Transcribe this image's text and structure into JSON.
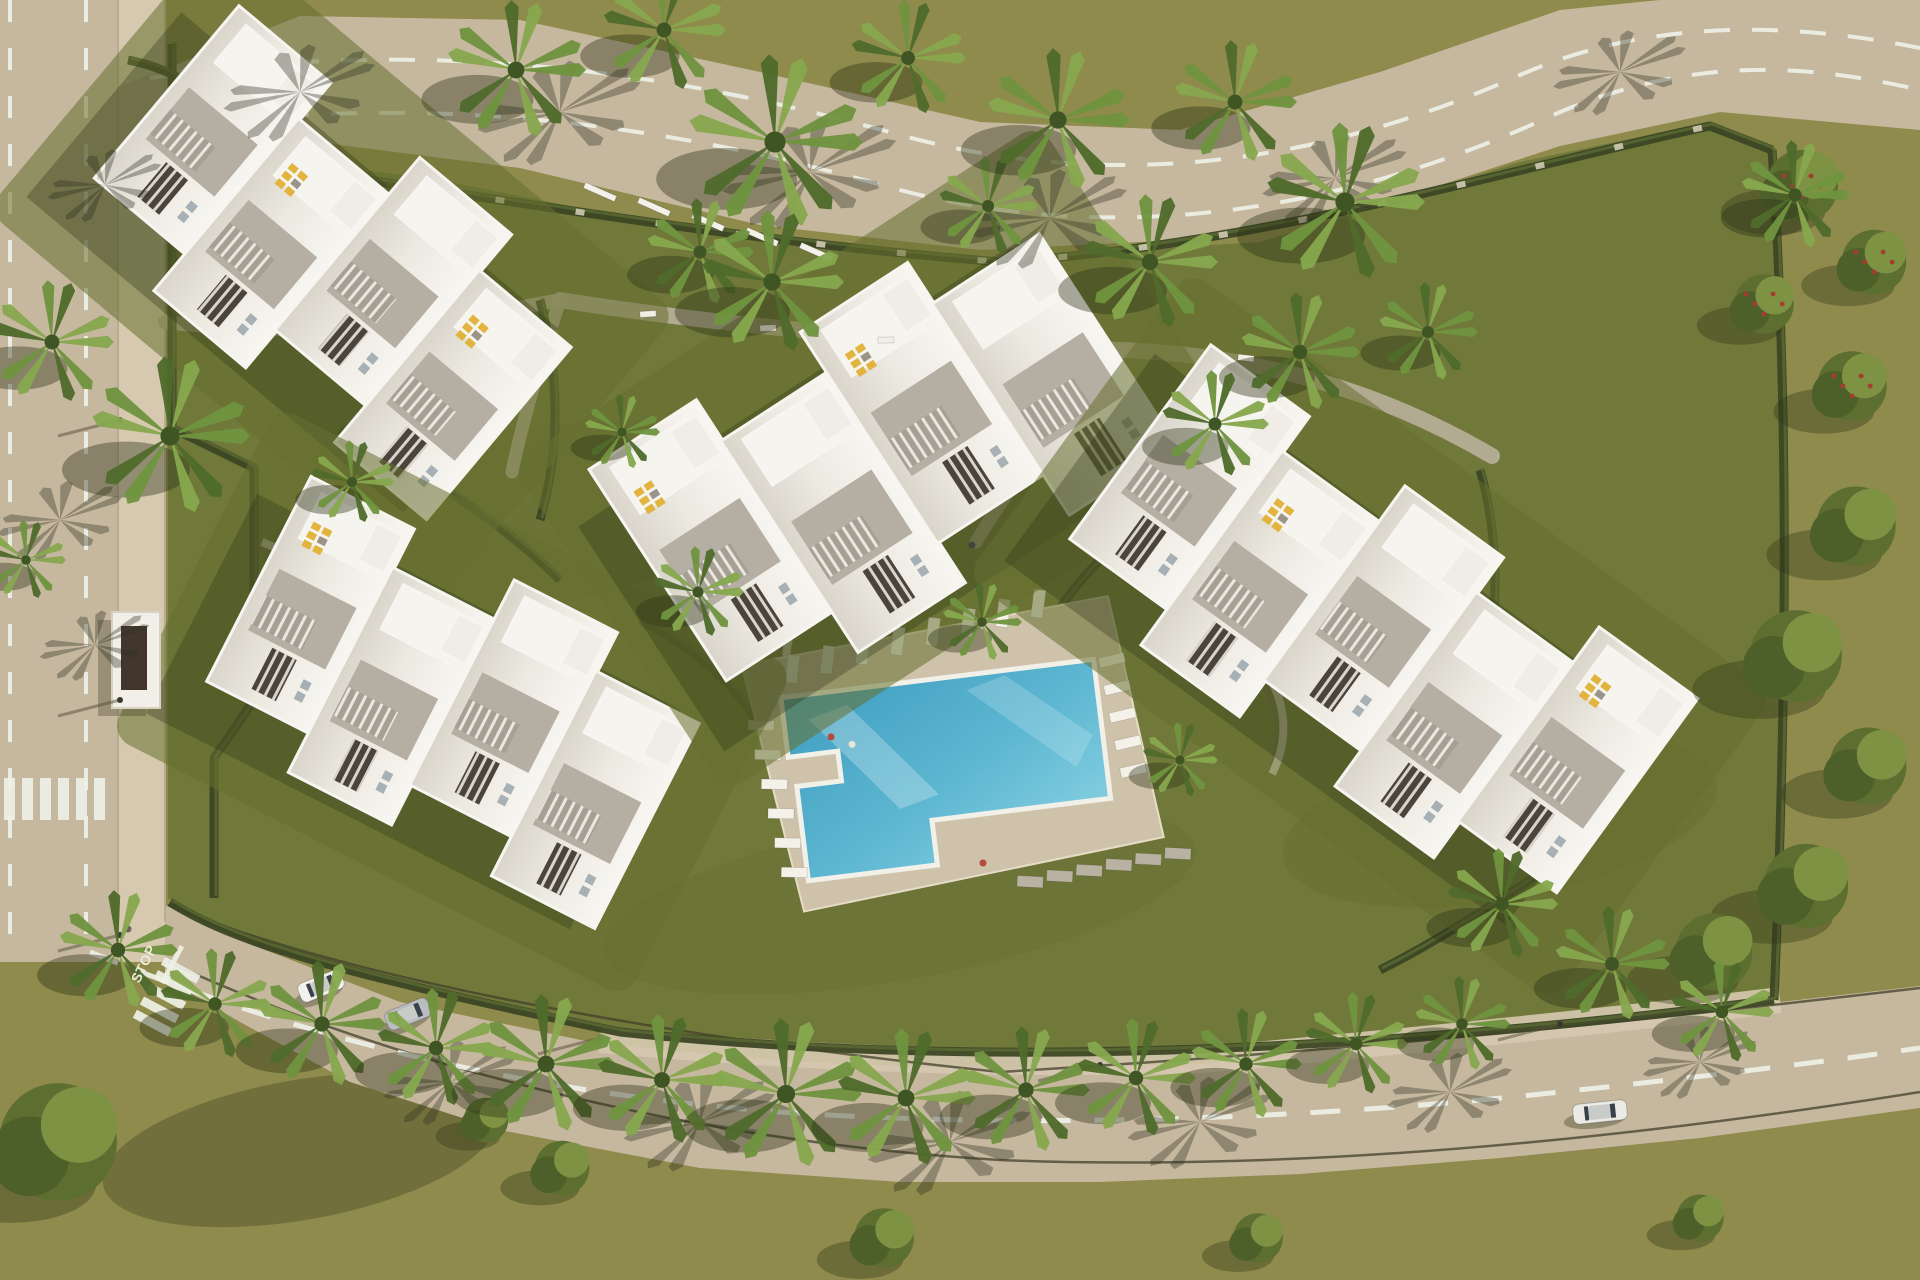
{
  "meta": {
    "description": "Aerial 3D render of a white apartment complex with cross-shaped pool, gardens, palm trees and curving roads",
    "width": 1920,
    "height": 1280
  },
  "palette": {
    "grass_outer": "#8e8b4c",
    "grass_site": "#71793a",
    "plot_tint": "#667030",
    "road": "#c6b89f",
    "sidewalk": "#d6c9b0",
    "road_line": "#eef0e6",
    "hedge": "#3c4624",
    "wall_light": "#d9d1be",
    "path": "#b6ad97",
    "roof_white": "#e9e6df",
    "roof_bright": "#f6f4ee",
    "roof_gray": "#b5aea3",
    "slot_dark": "#4a443b",
    "rail_bg": "#97918680",
    "parapet": "#f7f5f0",
    "lounger_yellow": "#e2b43e",
    "lounger_white": "#f3f1e8",
    "lounger_gray": "#b9b2a2",
    "pool_deck": "#cfc2aa",
    "pool_coping": "#f2f1e9",
    "water_dark": "#3e9dbf",
    "water_light": "#8fd5e5",
    "shadow": "#2e3317",
    "palm_light": "#86a84e",
    "palm_mid": "#6f9440",
    "palm_dark": "#4f6b2c",
    "tree_base": "#5c6e30",
    "tree_hi": "#7d9243",
    "flower_red": "#a33d2e"
  },
  "ground": {
    "site_poly": [
      [
        168,
        148
      ],
      [
        430,
        178
      ],
      [
        700,
        232
      ],
      [
        1000,
        258
      ],
      [
        1260,
        242
      ],
      [
        1520,
        162
      ],
      [
        1710,
        122
      ],
      [
        1775,
        148
      ],
      [
        1788,
        420
      ],
      [
        1782,
        720
      ],
      [
        1772,
        1000
      ],
      [
        1400,
        1044
      ],
      [
        1000,
        1068
      ],
      [
        620,
        1028
      ],
      [
        330,
        968
      ],
      [
        200,
        928
      ],
      [
        168,
        898
      ]
    ],
    "shade_blobs": [
      [
        520,
        520,
        260,
        90,
        0.08
      ],
      [
        1500,
        820,
        220,
        80,
        0.08
      ],
      [
        900,
        900,
        300,
        80,
        0.07
      ],
      [
        300,
        1150,
        200,
        70,
        0.3
      ]
    ]
  },
  "roads": {
    "left": {
      "x": 0,
      "w": 118,
      "sidewalk_w": 47,
      "y0": 0,
      "y1": 962
    },
    "left_dash_x": [
      10,
      86
    ],
    "top_poly": [
      [
        60,
        110
      ],
      [
        300,
        16
      ],
      [
        520,
        20
      ],
      [
        760,
        72
      ],
      [
        980,
        122
      ],
      [
        1180,
        130
      ],
      [
        1380,
        72
      ],
      [
        1560,
        10
      ],
      [
        1660,
        0
      ],
      [
        1920,
        0
      ],
      [
        1920,
        130
      ],
      [
        1720,
        112
      ],
      [
        1560,
        146
      ],
      [
        1380,
        205
      ],
      [
        1180,
        240
      ],
      [
        980,
        250
      ],
      [
        760,
        225
      ],
      [
        520,
        168
      ],
      [
        300,
        140
      ],
      [
        160,
        148
      ],
      [
        60,
        190
      ]
    ],
    "top_dashes": [
      "M 150,78 C 400,40 640,62 900,135 C 1120,195 1330,160 1520,75 C 1650,18 1790,22 1920,48",
      "M 140,132 C 400,92 640,116 900,190 C 1120,248 1350,210 1560,112 C 1690,58 1800,62 1920,90"
    ],
    "bottom_poly": [
      [
        165,
        905
      ],
      [
        260,
        948
      ],
      [
        400,
        1002
      ],
      [
        600,
        1044
      ],
      [
        800,
        1062
      ],
      [
        1000,
        1070
      ],
      [
        1200,
        1064
      ],
      [
        1400,
        1044
      ],
      [
        1600,
        1024
      ],
      [
        1780,
        1002
      ],
      [
        1920,
        986
      ],
      [
        1920,
        1108
      ],
      [
        1700,
        1138
      ],
      [
        1500,
        1158
      ],
      [
        1300,
        1174
      ],
      [
        1100,
        1182
      ],
      [
        900,
        1182
      ],
      [
        700,
        1168
      ],
      [
        500,
        1130
      ],
      [
        350,
        1082
      ],
      [
        240,
        1022
      ],
      [
        165,
        978
      ]
    ],
    "bottom_dash": "M 90,952 C 300,1038 520,1092 780,1112 C 1040,1130 1320,1118 1560,1092 C 1730,1074 1850,1058 1920,1048",
    "bottom_sidewalk": "M 600,1040 C 800,1058 1000,1066 1200,1060 C 1400,1042 1600,1022 1780,1000",
    "fence_lines": [
      "M 168,905 C 330,972 620,1032 1000,1072 C 1400,1048 1700,1014 1920,988",
      "M 168,962 C 400,1068 700,1142 1000,1160 C 1300,1172 1620,1140 1920,1092"
    ],
    "crosswalk_left": {
      "x": 4,
      "y": 778,
      "bars": 6,
      "bw": 11,
      "bh": 42,
      "gap": 7
    },
    "crosswalk_junction": {
      "cx": 168,
      "cy": 994,
      "rot": -62,
      "bars": 5,
      "bw": 9,
      "bh": 40,
      "gap": 6
    },
    "stop_text": "STOP",
    "stop_transform": "translate(148,966) rotate(-64)",
    "stop_line": {
      "x": 160,
      "y": 982,
      "w": 42,
      "h": 5,
      "rot": -62
    }
  },
  "hedges": [
    "M 175,152 C 430,186 700,238 1000,262 C 1260,246 1520,166 1710,126 L 1772,150",
    "M 1772,150 C 1790,420 1786,720 1774,1000",
    "M 1774,1000 C 1400,1048 1000,1072 620,1032 C 330,972 230,940 170,902",
    "M 172,44 L 172,428 L 254,468 L 254,700 L 214,758 L 214,898",
    "M 128,60 C 180,70 220,100 240,140",
    "M 640,620 C 700,650 740,690 770,740",
    "M 540,300 C 560,380 560,450 540,520",
    "M 1100,560 C 1060,600 1030,650 1010,700",
    "M 1480,470 C 1500,540 1500,620 1480,690",
    "M 340,430 C 420,470 500,520 560,580",
    "M 1560,860 C 1500,900 1440,940 1380,970"
  ],
  "walls": [
    "M 800,612 C 772,660 790,702 832,734 C 872,764 882,806 862,848",
    "M 1238,514 C 1212,562 1218,612 1252,652 C 1286,692 1292,734 1272,774",
    "M 262,542 C 312,562 352,602 382,656",
    "M 212,176 C 262,206 302,252 320,302"
  ],
  "pilaster_path": "M 175,152 C 430,186 700,238 1000,262 C 1260,246 1520,166 1710,126",
  "paths": [
    {
      "d": "M 560,300 C 760,332 980,346 1120,350 C 1280,356 1400,402 1492,456",
      "w": 16
    },
    {
      "d": "M 1120,350 C 1062,420 1012,482 976,542",
      "w": 13
    },
    {
      "d": "M 560,300 C 540,362 522,422 512,472",
      "w": 13
    },
    {
      "d": "M 165,322 C 300,338 430,326 560,300",
      "w": 14
    }
  ],
  "pool": {
    "cx": 955,
    "cy": 762,
    "rot": -7,
    "deck": [
      [
        -200,
        -122
      ],
      [
        172,
        -146
      ],
      [
        198,
        100
      ],
      [
        -168,
        130
      ]
    ],
    "water_path": "M -165,-85 L 150,-85 L 150,55 L -30,55 L -30,100 L -160,100 L -160,5 L -115,5 L -115,-25 L -165,-25 Z",
    "lounger_rows": [
      {
        "x0": -150,
        "y0": -112,
        "dx": 36,
        "dy": -5,
        "n": 8,
        "w": 12,
        "h": 28,
        "rot": 14,
        "tone": "#f3f1e8"
      },
      {
        "x0": -188,
        "y0": -60,
        "dx": 3,
        "dy": 30,
        "n": 6,
        "w": 26,
        "h": 10,
        "rot": 8,
        "tone": "#f3f1e8"
      },
      {
        "x0": 168,
        "y0": -82,
        "dx": 2,
        "dy": 28,
        "n": 5,
        "w": 26,
        "h": 10,
        "rot": -6,
        "tone": "#f3f1e8"
      },
      {
        "x0": 60,
        "y0": 128,
        "dx": 30,
        "dy": -2,
        "n": 6,
        "w": 11,
        "h": 26,
        "rot": 100,
        "tone": "#b9b2a2"
      }
    ],
    "figures": [
      [
        -120,
        -40,
        "#b44b3c"
      ],
      [
        -100,
        -30,
        "#e8e5da"
      ]
    ]
  },
  "buildings": [
    {
      "name": "top-left",
      "cx": 332,
      "cy": 262,
      "rot": 40,
      "units": 4,
      "uw": 118,
      "uh": 225,
      "zig": 24,
      "lounger_units": [
        1,
        3
      ]
    },
    {
      "name": "west",
      "cx": 452,
      "cy": 702,
      "rot": 27,
      "units": 4,
      "uw": 114,
      "uh": 230,
      "zig": 22,
      "lounger_units": [
        0
      ]
    },
    {
      "name": "center",
      "cx": 882,
      "cy": 458,
      "rot": -33,
      "units": 4,
      "uw": 126,
      "uh": 252,
      "zig": 24,
      "lounger_units": [
        0,
        2
      ]
    },
    {
      "name": "east",
      "cx": 1370,
      "cy": 636,
      "rot": 36,
      "units": 5,
      "uw": 120,
      "uh": 240,
      "zig": 22,
      "lounger_units": [
        1,
        4
      ]
    }
  ],
  "furniture": {
    "bus_shelter": {
      "x": 112,
      "y": 612,
      "w": 48,
      "h": 96
    },
    "benches": [
      [
        648,
        314,
        -4
      ],
      [
        768,
        328,
        -3
      ],
      [
        886,
        340,
        -2
      ],
      [
        1246,
        358,
        6
      ]
    ],
    "pergola": {
      "x": 600,
      "y": 192,
      "count": 5,
      "stepx": 54,
      "stepy": 15,
      "rot": 24
    },
    "lamps": [
      [
        120,
        420
      ],
      [
        120,
        700
      ],
      [
        120,
        935
      ],
      [
        600,
        1038
      ],
      [
        1100,
        1065
      ],
      [
        1560,
        1024
      ]
    ]
  },
  "vehicles": [
    {
      "type": "car",
      "x": 321,
      "y": 986,
      "rot": -22,
      "color": "#f2f1ed"
    },
    {
      "type": "car",
      "x": 408,
      "y": 1014,
      "rot": -22,
      "color": "#b9bcc0"
    },
    {
      "type": "van",
      "x": 1600,
      "y": 1112,
      "rot": -6,
      "color": "#eceae4"
    }
  ],
  "figures": [
    [
      983,
      863,
      "#b44b3c"
    ],
    [
      972,
      545,
      "#454540"
    ],
    [
      128,
      929,
      "#6a665c"
    ]
  ],
  "palm_road_shadows": [
    [
      300,
      92,
      80
    ],
    [
      560,
      112,
      86
    ],
    [
      810,
      172,
      92
    ],
    [
      1050,
      218,
      82
    ],
    [
      1335,
      178,
      76
    ],
    [
      1620,
      72,
      70
    ],
    [
      105,
      185,
      60
    ],
    [
      60,
      520,
      66
    ],
    [
      95,
      645,
      58
    ],
    [
      450,
      1082,
      70
    ],
    [
      700,
      1122,
      80
    ],
    [
      950,
      1142,
      86
    ],
    [
      1200,
      1122,
      76
    ],
    [
      1450,
      1092,
      66
    ],
    [
      1700,
      1062,
      60
    ]
  ],
  "palms": [
    [
      52,
      342,
      62
    ],
    [
      170,
      436,
      80
    ],
    [
      26,
      560,
      40
    ],
    [
      516,
      70,
      70
    ],
    [
      664,
      30,
      62
    ],
    [
      775,
      142,
      88
    ],
    [
      908,
      58,
      58
    ],
    [
      700,
      252,
      54
    ],
    [
      988,
      206,
      50
    ],
    [
      1058,
      120,
      72
    ],
    [
      1150,
      262,
      68
    ],
    [
      1235,
      102,
      62
    ],
    [
      1345,
      202,
      80
    ],
    [
      1300,
      352,
      60
    ],
    [
      1215,
      424,
      54
    ],
    [
      1428,
      332,
      50
    ],
    [
      772,
      282,
      72
    ],
    [
      118,
      950,
      60
    ],
    [
      215,
      1004,
      56
    ],
    [
      322,
      1024,
      64
    ],
    [
      436,
      1048,
      60
    ],
    [
      546,
      1064,
      70
    ],
    [
      662,
      1080,
      66
    ],
    [
      786,
      1094,
      76
    ],
    [
      906,
      1098,
      70
    ],
    [
      1026,
      1090,
      64
    ],
    [
      1136,
      1078,
      60
    ],
    [
      1246,
      1064,
      56
    ],
    [
      1356,
      1044,
      52
    ],
    [
      1462,
      1024,
      48
    ],
    [
      1502,
      904,
      56
    ],
    [
      1612,
      964,
      58
    ],
    [
      1722,
      1012,
      52
    ],
    [
      1795,
      195,
      55
    ],
    [
      352,
      482,
      42
    ],
    [
      622,
      432,
      38
    ],
    [
      698,
      592,
      46
    ],
    [
      982,
      622,
      40
    ],
    [
      1180,
      760,
      38
    ]
  ],
  "trees": [
    [
      1802,
      186,
      58
    ],
    [
      1874,
      262,
      52
    ],
    [
      1764,
      304,
      48
    ],
    [
      1852,
      386,
      56
    ],
    [
      1856,
      526,
      64
    ],
    [
      1796,
      656,
      74
    ],
    [
      1868,
      766,
      62
    ],
    [
      1806,
      886,
      68
    ],
    [
      1714,
      952,
      62
    ],
    [
      58,
      1142,
      95
    ],
    [
      562,
      1168,
      44
    ],
    [
      884,
      1238,
      48
    ],
    [
      1258,
      1238,
      40
    ],
    [
      486,
      1120,
      36
    ],
    [
      1700,
      1218,
      38
    ]
  ],
  "flower_trees": [
    0,
    1,
    2,
    3
  ]
}
